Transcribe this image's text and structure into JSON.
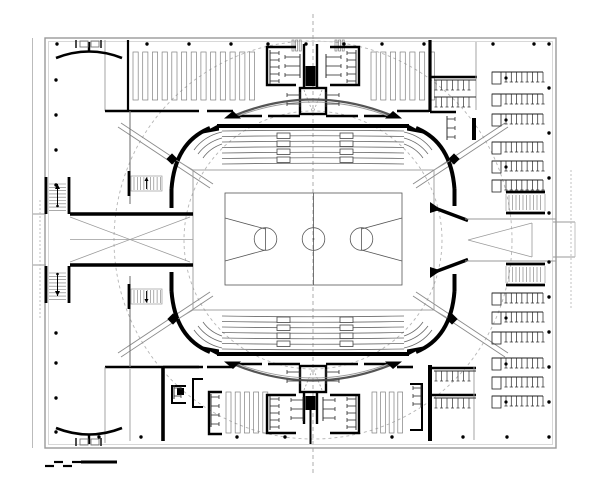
{
  "meta": {
    "drawing": "sports-hall-arena-floor-plan",
    "width": 600,
    "height": 485,
    "background": "#ffffff"
  },
  "colors": {
    "wall": "#000000",
    "shell": "#9a9a9a",
    "shell_light": "#cfcfcf",
    "guide": "#b5b5b5",
    "seat_row": "#6a6a6a",
    "fixture": "#2f2f2f",
    "hatch": "#808080",
    "ramp": "#8a8a8a",
    "tread": "#777777"
  },
  "guides": {
    "circles": [
      {
        "cx": 313,
        "cy": 240,
        "r": 199
      },
      {
        "cx": 313,
        "cy": 240,
        "r": 129
      }
    ],
    "centerline": {
      "x": 313,
      "y1": 14,
      "y2": 473
    },
    "ramps": [
      [
        121,
        123,
        213,
        184
      ],
      [
        118,
        127,
        210,
        188
      ],
      [
        505,
        123,
        413,
        184
      ],
      [
        508,
        127,
        416,
        188
      ],
      [
        121,
        357,
        213,
        296
      ],
      [
        118,
        353,
        210,
        292
      ],
      [
        505,
        357,
        413,
        296
      ],
      [
        508,
        353,
        416,
        292
      ]
    ]
  },
  "column_dots": {
    "r": 1.7,
    "top": {
      "y": 44,
      "x": [
        57,
        147,
        189,
        231,
        268,
        306,
        344,
        382,
        424,
        493,
        534
      ]
    },
    "left": {
      "x": 56,
      "y": [
        80,
        115,
        150,
        185,
        333,
        363,
        398,
        432
      ]
    },
    "right": {
      "x": 549,
      "y": [
        44,
        88,
        133,
        178,
        213,
        262,
        297,
        332,
        367,
        402,
        437
      ]
    },
    "bottom": {
      "y": 437,
      "x": [
        99,
        141,
        237,
        285,
        392,
        463,
        507
      ]
    }
  },
  "hatch_bands": [
    {
      "x": 133,
      "count": 13,
      "step": 9.7,
      "w": 5.2,
      "y": 52,
      "h": 48
    },
    {
      "x": 371,
      "count": 7,
      "step": 9.7,
      "w": 5.2,
      "y": 52,
      "h": 48
    },
    {
      "x": 226,
      "count": 5,
      "step": 9.2,
      "w": 5.0,
      "y": 392,
      "h": 41
    },
    {
      "x": 372,
      "count": 4,
      "step": 8.6,
      "w": 4.8,
      "y": 392,
      "h": 41
    },
    {
      "x": 292,
      "count": 3,
      "step": 3.6,
      "w": 2.0,
      "y": 40,
      "h": 11
    },
    {
      "x": 335,
      "count": 3,
      "step": 3.6,
      "w": 2.0,
      "y": 40,
      "h": 11
    }
  ],
  "seat_rows": {
    "x1": 222,
    "x2": 404,
    "top_y": [
      131,
      136.5,
      142,
      147.5,
      153,
      158.5,
      164
    ],
    "bottom_y": [
      349,
      343.5,
      338,
      332.5,
      327,
      321.5,
      316
    ]
  },
  "vomitories": {
    "w": 13,
    "h": 5.5,
    "clusters": [
      {
        "x": 277,
        "ys": [
          133,
          141,
          149,
          157
        ]
      },
      {
        "x": 340,
        "ys": [
          133,
          141,
          149,
          157
        ]
      },
      {
        "x": 277,
        "ys": [
          317,
          325,
          333,
          341
        ]
      },
      {
        "x": 340,
        "ys": [
          317,
          325,
          333,
          341
        ]
      }
    ]
  },
  "gates": {
    "size": 8,
    "centers": [
      [
        172,
        159
      ],
      [
        454,
        159
      ],
      [
        173,
        319
      ],
      [
        452,
        319
      ]
    ]
  },
  "bench_rows": {
    "x": 492,
    "w": 51,
    "tick_len": 10,
    "ticks": 7,
    "box_w": 9,
    "box_h": 12,
    "top_y": [
      72,
      94,
      114,
      142,
      161,
      180
    ],
    "bottom_y": [
      293,
      312,
      332,
      358,
      377,
      396
    ],
    "dot_top": [
      0,
      2,
      4
    ],
    "dot_bottom": [
      1,
      3,
      5
    ],
    "dot_x": 506
  },
  "stairs": [
    {
      "type": "v",
      "x": 46,
      "y": 177,
      "w": 23,
      "h": 37,
      "arrow": "up"
    },
    {
      "type": "v",
      "x": 46,
      "y": 266,
      "w": 23,
      "h": 37,
      "arrow": "down"
    },
    {
      "type": "h",
      "x": 131,
      "y": 176,
      "w": 31,
      "h": 15,
      "wall_x": 129,
      "arrow": "up"
    },
    {
      "type": "h",
      "x": 131,
      "y": 289,
      "w": 31,
      "h": 15,
      "wall_x": 129,
      "arrow": "down"
    },
    {
      "type": "e",
      "x": 506,
      "y": 192,
      "w": 39,
      "h": 21
    },
    {
      "type": "e",
      "x": 506,
      "y": 264,
      "w": 39,
      "h": 21
    }
  ],
  "fixture_combs": [
    {
      "x": 270,
      "y": 53,
      "dir": "r",
      "n": 5,
      "step": 7,
      "len": 9
    },
    {
      "x": 356,
      "y": 53,
      "dir": "l",
      "n": 5,
      "step": 7,
      "len": 9
    },
    {
      "x": 300,
      "y": 57,
      "dir": "l",
      "n": 3,
      "step": 9,
      "len": 15
    },
    {
      "x": 326,
      "y": 57,
      "dir": "r",
      "n": 3,
      "step": 9,
      "len": 15
    },
    {
      "x": 300,
      "y": 95,
      "dir": "l",
      "n": 2,
      "step": 9,
      "len": 13
    },
    {
      "x": 326,
      "y": 95,
      "dir": "r",
      "n": 2,
      "step": 9,
      "len": 13
    },
    {
      "x": 270,
      "y": 399,
      "dir": "r",
      "n": 5,
      "step": 7,
      "len": 9
    },
    {
      "x": 356,
      "y": 399,
      "dir": "l",
      "n": 5,
      "step": 7,
      "len": 9
    },
    {
      "x": 300,
      "y": 372,
      "dir": "l",
      "n": 2,
      "step": 9,
      "len": 13
    },
    {
      "x": 326,
      "y": 372,
      "dir": "r",
      "n": 2,
      "step": 9,
      "len": 13
    },
    {
      "x": 303,
      "y": 400,
      "dir": "l",
      "n": 3,
      "step": 9,
      "len": 12
    },
    {
      "x": 323,
      "y": 400,
      "dir": "r",
      "n": 3,
      "step": 9,
      "len": 12
    },
    {
      "x": 211,
      "y": 397,
      "dir": "r",
      "n": 4,
      "step": 9,
      "len": 8
    },
    {
      "x": 447,
      "y": 119,
      "dir": "r",
      "n": 3,
      "step": 9,
      "len": 8
    },
    {
      "x": 421,
      "y": 388,
      "dir": "l",
      "n": 3,
      "step": 8,
      "len": 8
    },
    {
      "x": 174,
      "y": 388,
      "dir": "r",
      "n": 2,
      "step": 8,
      "len": 7
    }
  ],
  "fixture_rows": [
    {
      "x1": 436,
      "x2": 474,
      "y": 80,
      "step": 5.5,
      "len": 10
    },
    {
      "x1": 436,
      "x2": 474,
      "y": 97,
      "step": 5.5,
      "len": 10
    },
    {
      "x1": 436,
      "x2": 474,
      "y": 371,
      "step": 5.5,
      "len": 10
    },
    {
      "x1": 436,
      "x2": 474,
      "y": 398,
      "step": 5.5,
      "len": 10
    }
  ],
  "court": {
    "x": 225,
    "y": 193,
    "w": 177,
    "h": 92,
    "center_x": 313.5,
    "center_y": 239,
    "circle_r": 11.3,
    "ft_left_x": 265.5,
    "ft_right_x": 361.5,
    "ft_r": 11.3,
    "key_base_y1": 218,
    "key_base_y2": 261,
    "key_ft_y1": 229,
    "key_ft_y2": 250
  },
  "scale_bar": {
    "steps": [
      [
        45,
        54,
        466
      ],
      [
        54,
        63,
        462
      ],
      [
        63,
        72,
        466
      ],
      [
        72,
        81,
        462
      ]
    ],
    "bar": {
      "x1": 81,
      "x2": 117,
      "y": 462,
      "t": 3
    }
  }
}
